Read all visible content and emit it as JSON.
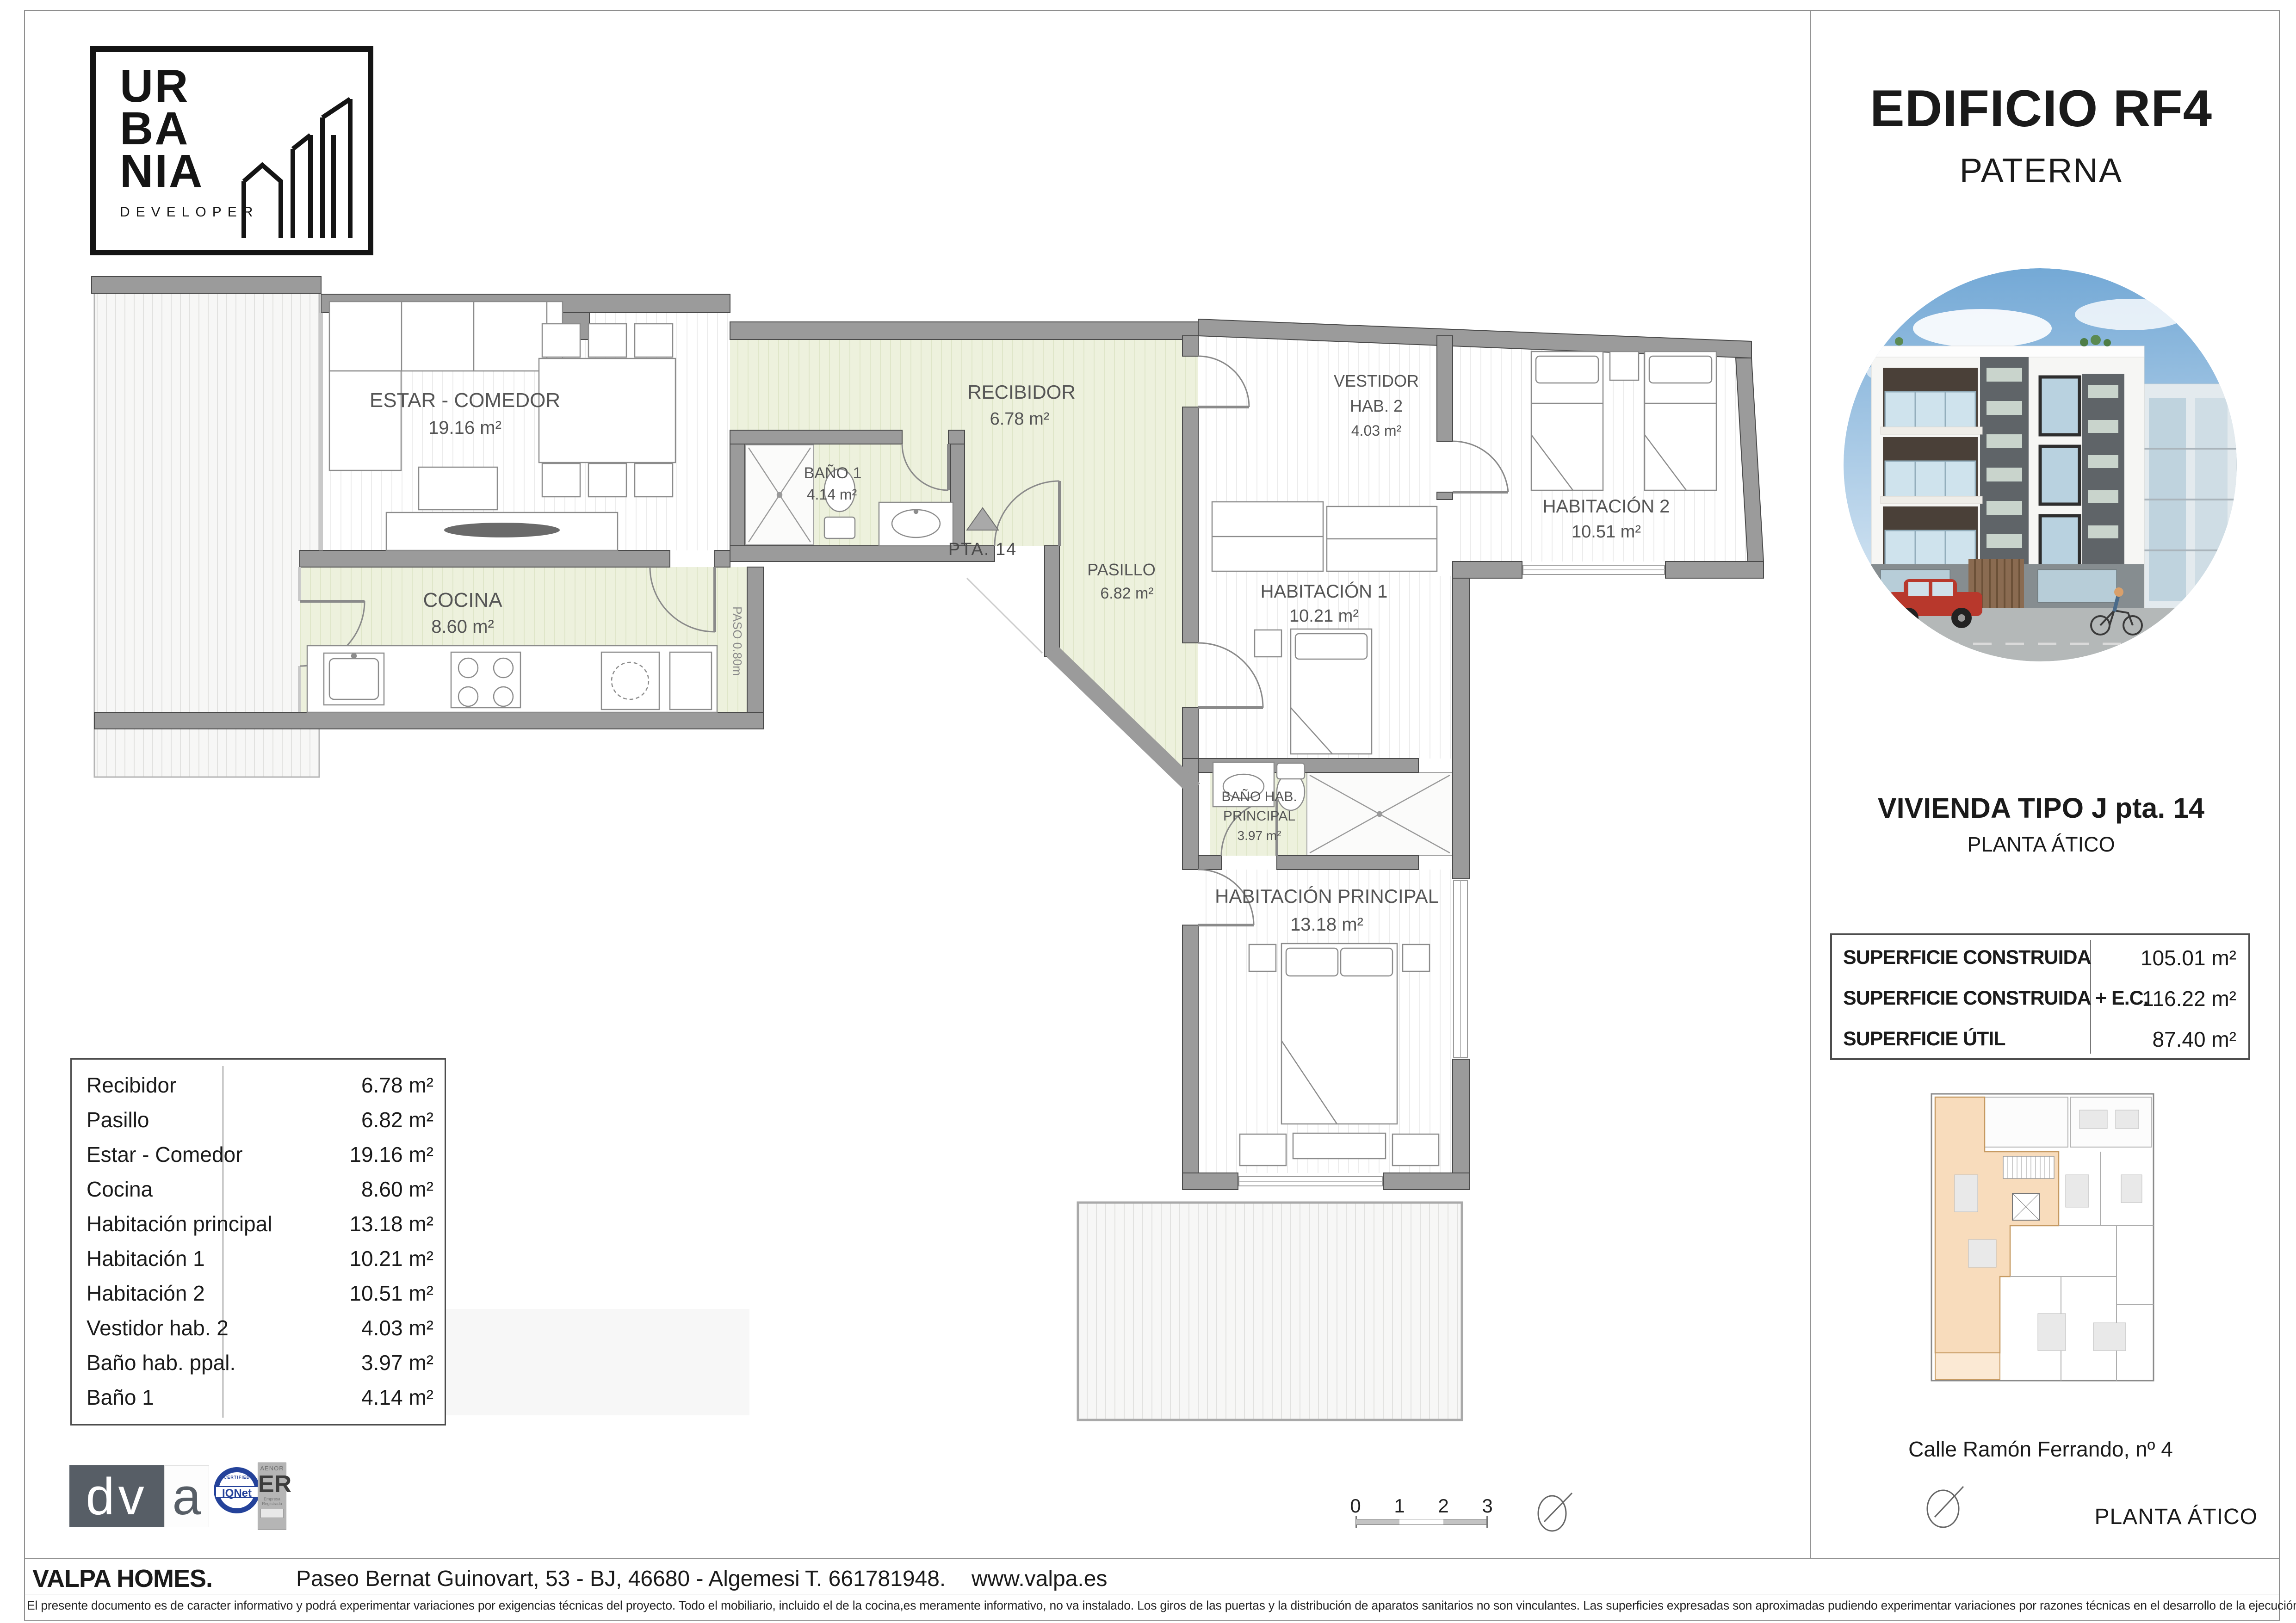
{
  "logo": {
    "l1": "UR",
    "l2": "BA",
    "l3": "NIA",
    "sub": "DEVELOPER"
  },
  "panel": {
    "title": "EDIFICIO RF4",
    "subtitle": "PATERNA",
    "unit_title": "VIVIENDA TIPO J pta. 14",
    "unit_floor": "PLANTA ÁTICO",
    "surfaces": [
      {
        "label": "SUPERFICIE CONSTRUIDA",
        "value": "105.01 m²"
      },
      {
        "label": "SUPERFICIE CONSTRUIDA + E.C.",
        "value": "116.22 m²"
      },
      {
        "label": "SUPERFICIE ÚTIL",
        "value": "87.40 m²"
      }
    ],
    "address": "Calle Ramón Ferrando, nº 4",
    "floor_label": "PLANTA ÁTICO"
  },
  "plan": {
    "estar_name": "ESTAR - COMEDOR",
    "estar_area": "19.16 m²",
    "cocina_name": "COCINA",
    "cocina_area": "8.60 m²",
    "recibidor_name": "RECIBIDOR",
    "recibidor_area": "6.78 m²",
    "bano1_name": "BAÑO 1",
    "bano1_area": "4.14 m²",
    "pasillo_name": "PASILLO",
    "pasillo_area": "6.82 m²",
    "vestidor_l1": "VESTIDOR",
    "vestidor_l2": "HAB. 2",
    "vestidor_area": "4.03 m²",
    "hab1_name": "HABITACIÓN 1",
    "hab1_area": "10.21 m²",
    "hab2_name": "HABITACIÓN 2",
    "hab2_area": "10.51 m²",
    "banoppal_l1": "BAÑO HAB.",
    "banoppal_l2": "PRINCIPAL",
    "banoppal_area": "3.97 m²",
    "habppal_name": "HABITACIÓN PRINCIPAL",
    "habppal_area": "13.18 m²",
    "pta_label": "PTA. 14",
    "paso_label": "PASO 0.80m"
  },
  "room_table": {
    "rows": [
      {
        "label": "Recibidor",
        "value": "6.78 m²"
      },
      {
        "label": "Pasillo",
        "value": "6.82 m²"
      },
      {
        "label": "Estar - Comedor",
        "value": "19.16 m²"
      },
      {
        "label": "Cocina",
        "value": "8.60 m²"
      },
      {
        "label": "Habitación principal",
        "value": "13.18 m²"
      },
      {
        "label": "Habitación 1",
        "value": "10.21 m²"
      },
      {
        "label": "Habitación 2",
        "value": "10.51 m²"
      },
      {
        "label": "Vestidor hab. 2",
        "value": "4.03 m²"
      },
      {
        "label": "Baño hab. ppal.",
        "value": "3.97 m²"
      },
      {
        "label": "Baño 1",
        "value": "4.14 m²"
      }
    ]
  },
  "scalebar": {
    "ticks": [
      "0",
      "1",
      "2",
      "3"
    ]
  },
  "footer": {
    "company": "VALPA HOMES.",
    "address": "Paseo Bernat Guinovart, 53 - BJ, 46680 - Algemesi",
    "phone": "T. 661781948.",
    "web": "www.valpa.es",
    "disclaimer": "El presente documento es de caracter informativo y podrá experimentar variaciones por exigencias técnicas del proyecto. Todo el mobiliario, incluido el de la cocina,es meramente informativo, no va instalado. Los giros de las puertas y la distribución de aparatos sanitarios no son vinculantes. Las superficies expresadas son aproximadas pudiendo experimentar variaciones por razones técnicas en el desarrollo de la ejecución de la obra."
  },
  "logos": {
    "dva_dv": "dv",
    "dva_a": "a",
    "iqnet": "IQNet",
    "iqnet_top": "CERTIFIED",
    "aenor_top": "AENOR",
    "aenor_er": "ER",
    "aenor_s1": "Empresa",
    "aenor_s2": "Registrada"
  },
  "colors": {
    "wall": "#9b9b9b",
    "green_room": "#edf1dd",
    "accent_unit": "#f8dcbc",
    "iqnet_blue": "#24429a"
  }
}
